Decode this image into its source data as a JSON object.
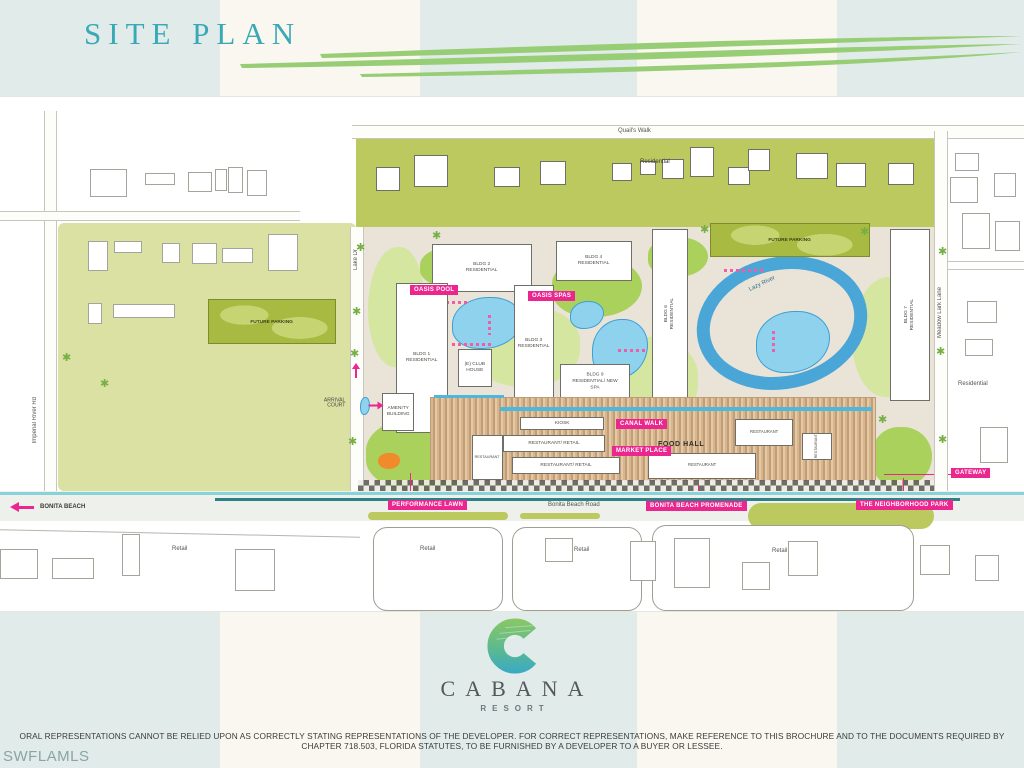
{
  "header": {
    "title": "SITE PLAN"
  },
  "map": {
    "roads": {
      "quails_walk": "Quail's Walk",
      "kens_way": "Kens Way",
      "lake_dr": "Lake Dr",
      "imperial_river_rd": "Imperial River Rd",
      "meadow_lark_lane": "Meadow Lark Lane",
      "bonita_beach_road": "Bonita Beach Road",
      "bonita_beach": "BONITA BEACH"
    },
    "areas": {
      "residential_top": "Residential",
      "residential_right": "Residential",
      "future_parking": "FUTURE PARKING",
      "arrival_court": "ARRIVAL\nCOURT",
      "retail": "Retail"
    },
    "buildings": {
      "bldg1": "BLDG 1\nRESIDENTIAL",
      "bldg2": "BLDG 2\nRESIDENTIAL",
      "bldg3": "BLDG 3\nRESIDENTIAL",
      "bldg4": "BLDG 4\nRESIDENTIAL",
      "bldg6": "BLDG 6\nRESIDENTIAL",
      "bldg7": "BLDG 7\nRESIDENTIAL",
      "bldg9": "BLDG 9\nRESIDENTIAL/ NEW SPA",
      "club_house": "(E) CLUB\nHOUSE",
      "amenity_building": "AMENITY\nBUILDING",
      "kiosk": "KIOSK",
      "restaurant": "RESTAURANT",
      "restaurant_retail": "RESTAURANT/ RETAIL",
      "food_hall": "FOOD HALL"
    },
    "features": {
      "oasis_pool": "OASIS POOL",
      "oasis_spas": "OASIS SPAS",
      "lazy_river": "Lazy River",
      "canal_walk": "CANAL WALK",
      "market_place": "MARKET PLACE",
      "performance_lawn": "PERFORMANCE LAWN",
      "bonita_beach_promenade": "BONITA BEACH PROMENADE",
      "neighborhood_park": "THE NEIGHBORHOOD PARK",
      "gateway": "GATEWAY"
    }
  },
  "logo": {
    "brand": "CABANA",
    "subtitle": "RESORT"
  },
  "footer": {
    "disclaimer": "ORAL REPRESENTATIONS CANNOT BE RELIED UPON AS CORRECTLY STATING REPRESENTATIONS OF THE DEVELOPER. FOR CORRECT REPRESENTATIONS, MAKE REFERENCE TO THIS BROCHURE AND TO THE DOCUMENTS REQUIRED BY CHAPTER 718.503, FLORIDA STATUTES, TO BE FURNISHED BY A DEVELOPER TO A BUYER OR LESSEE.",
    "watermark": "SWFLAMLS"
  },
  "colors": {
    "accent_pink": "#EC268F",
    "title_teal": "#39A9B6",
    "olive_green": "#BCC95F",
    "water_blue": "#7FCBE8",
    "swoosh_green": "#97CD74"
  }
}
